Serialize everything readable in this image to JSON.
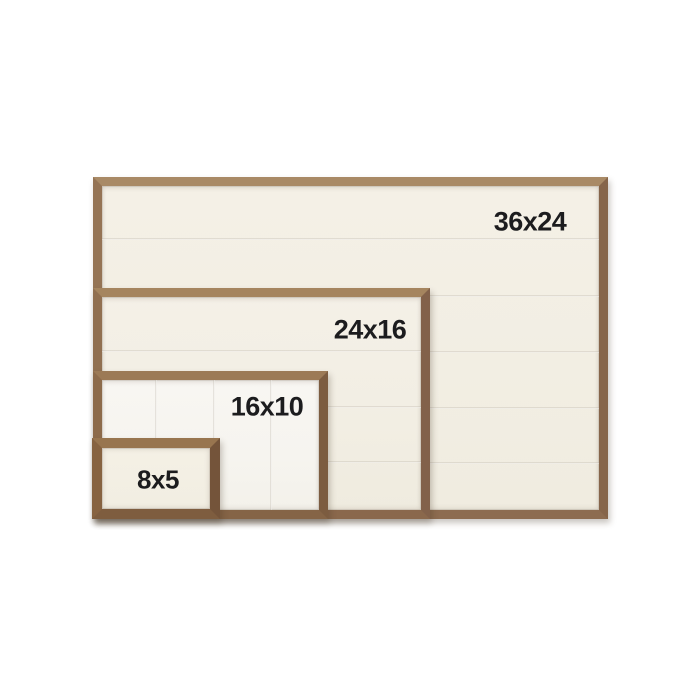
{
  "figure": {
    "background_color": "#ffffff",
    "description_colors": {
      "wood_frame": "#8d6c50",
      "board_cream": "#f2eee3",
      "board_white": "#f6f4ef",
      "label_text": "#1c1c1e"
    },
    "frames": [
      {
        "label": "36x24",
        "plank_direction": "horizontal",
        "plank_seams": 5
      },
      {
        "label": "24x16",
        "plank_direction": "horizontal",
        "plank_seams": 3
      },
      {
        "label": "16x10",
        "plank_direction": "vertical",
        "plank_seams": 3
      },
      {
        "label": "8x5",
        "plank_direction": "none",
        "plank_seams": 0
      }
    ]
  }
}
